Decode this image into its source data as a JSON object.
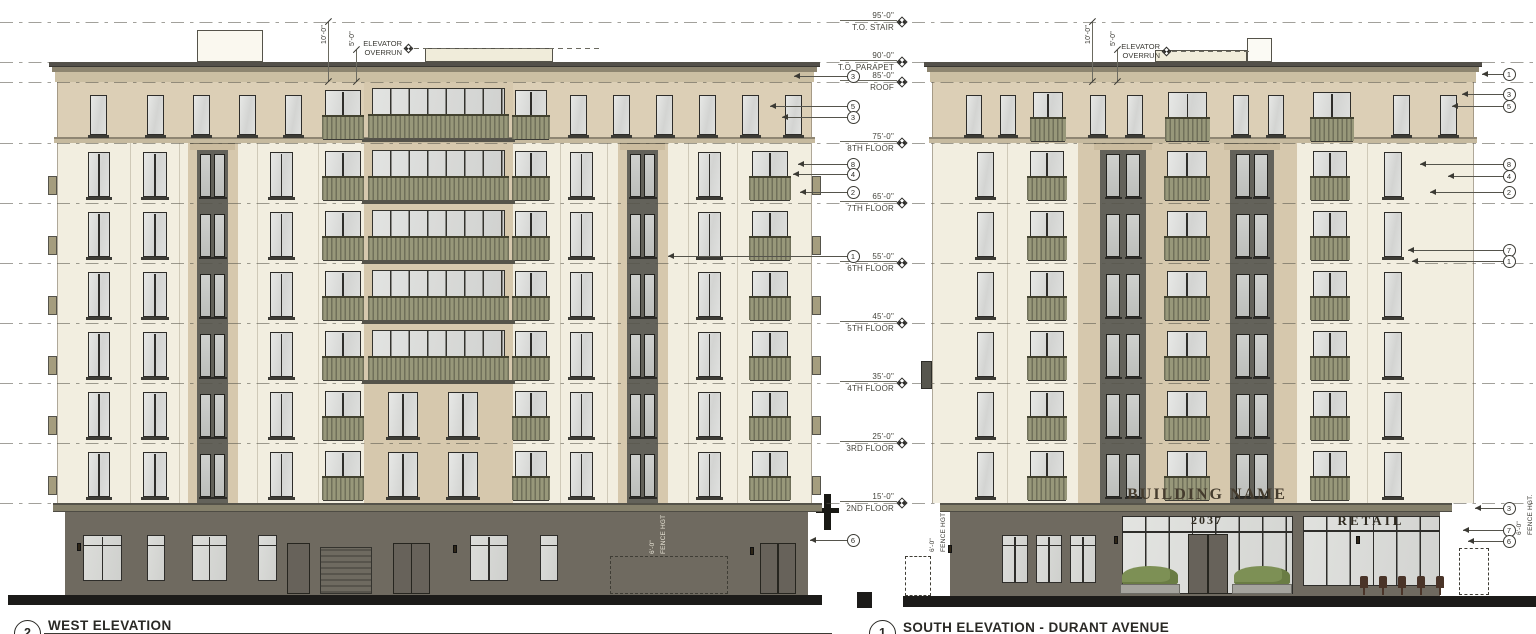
{
  "drawing_title": "Building Elevations",
  "colors": {
    "paper": "#ffffff",
    "cream_wall": "#f2eee0",
    "tan_band": "#dccfb6",
    "pilaster": "#d6c8ad",
    "dark_panel": "#63625a",
    "ground_wall": "#6f6a60",
    "awning_band": "#85806b",
    "cornice_cap": "#53504a",
    "cornice_molding": "#8d8570",
    "cornice_fascia": "#cbbfa3",
    "floor_band": "#c6ba9f",
    "railing": "#98987a",
    "railing_dark": "#70705a",
    "frame": "#2e2d2a",
    "glass": "#dfe0de",
    "glass_dark": "#c4c6c3",
    "street": "#1c1b19",
    "line": "#55534a",
    "green_shrub": "#7d9055",
    "planter": "#a5a49e",
    "stool": "#4a3428"
  },
  "levels": [
    {
      "elev": "95'-0\"",
      "name": "T.O. STAIR"
    },
    {
      "elev": "90'-0\"",
      "name": "T.O. PARAPET"
    },
    {
      "elev": "85'-0\"",
      "name": "ROOF"
    },
    {
      "elev": "75'-0\"",
      "name": "8TH FLOOR"
    },
    {
      "elev": "65'-0\"",
      "name": "7TH FLOOR"
    },
    {
      "elev": "55'-0\"",
      "name": "6TH FLOOR"
    },
    {
      "elev": "45'-0\"",
      "name": "5TH FLOOR"
    },
    {
      "elev": "35'-0\"",
      "name": "4TH FLOOR"
    },
    {
      "elev": "25'-0\"",
      "name": "3RD FLOOR"
    },
    {
      "elev": "15'-0\"",
      "name": "2ND FLOOR"
    }
  ],
  "annotations": {
    "elevator_line1": "ELEVATOR",
    "elevator_line2": "OVERRUN",
    "dim_ten": "10'-0\"",
    "dim_five": "5'-0\"",
    "fence_dim": "6'-0\"",
    "fence_label": "FENCE HGT",
    "fence_label_dot": "FENCE HGT."
  },
  "west": {
    "sheet_number": "2",
    "title": "WEST ELEVATION",
    "callouts": [
      "3",
      "5",
      "3",
      "8",
      "4",
      "2",
      "1",
      "6"
    ]
  },
  "south": {
    "sheet_number": "1",
    "title": "SOUTH ELEVATION - DURANT AVENUE",
    "signs": {
      "building_name": "BUILDING NAME",
      "address": "2037",
      "retail": "RETAIL"
    },
    "callouts": [
      "1",
      "3",
      "5",
      "8",
      "4",
      "2",
      "7",
      "1",
      "3",
      "7",
      "6"
    ]
  }
}
